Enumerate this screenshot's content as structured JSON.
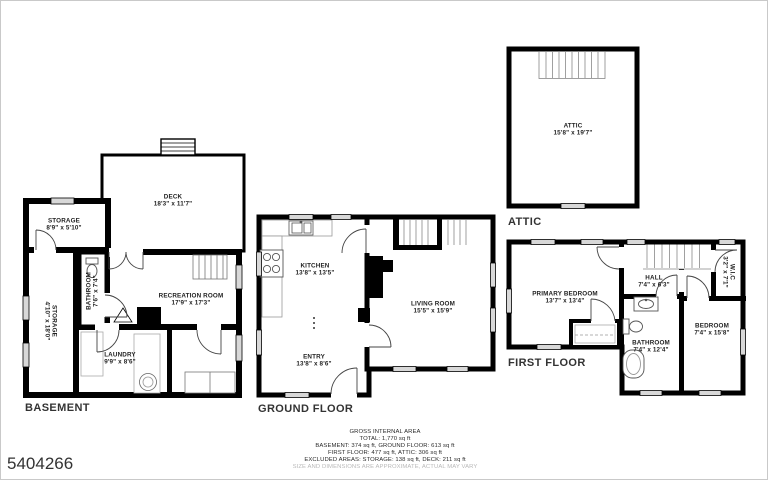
{
  "id_number": "5404266",
  "floors": {
    "basement": {
      "label": "BASEMENT",
      "rooms": {
        "deck": {
          "name": "DECK",
          "dims": "18'3\" x 11'7\""
        },
        "storage_top": {
          "name": "STORAGE",
          "dims": "8'9\" x 5'10\""
        },
        "storage_left": {
          "name": "STORAGE",
          "dims": "4'10\" x 18'0\""
        },
        "bathroom": {
          "name": "BATHROOM",
          "dims": "7'6\" x 7'4\""
        },
        "recreation": {
          "name": "RECREATION ROOM",
          "dims": "17'9\" x 17'3\""
        },
        "laundry": {
          "name": "LAUNDRY",
          "dims": "9'9\" x 8'6\""
        }
      }
    },
    "ground": {
      "label": "GROUND FLOOR",
      "rooms": {
        "kitchen": {
          "name": "KITCHEN",
          "dims": "13'8\" x 13'5\""
        },
        "living": {
          "name": "LIVING ROOM",
          "dims": "15'5\" x 15'9\""
        },
        "entry": {
          "name": "ENTRY",
          "dims": "13'8\" x 8'6\""
        }
      }
    },
    "first": {
      "label": "FIRST FLOOR",
      "rooms": {
        "primary": {
          "name": "PRIMARY BEDROOM",
          "dims": "13'7\" x 13'4\""
        },
        "hall": {
          "name": "HALL",
          "dims": "7'4\" x 6'3\""
        },
        "wic": {
          "name": "W.I.C",
          "dims": "3'2\" x 7'1\""
        },
        "bedroom": {
          "name": "BEDROOM",
          "dims": "7'4\" x 15'8\""
        },
        "bathroom": {
          "name": "BATHROOM",
          "dims": "7'4\" x 12'4\""
        }
      }
    },
    "attic": {
      "label": "ATTIC",
      "rooms": {
        "attic": {
          "name": "ATTIC",
          "dims": "15'8\" x 19'7\""
        }
      }
    }
  },
  "footer": {
    "line1": "GROSS INTERNAL AREA",
    "line2": "TOTAL: 1,770 sq ft",
    "line3": "BASEMENT: 374 sq ft, GROUND FLOOR: 613 sq ft",
    "line4": "FIRST FLOOR: 477 sq ft, ATTIC: 306 sq ft",
    "line5": "EXCLUDED AREAS: STORAGE: 138 sq ft, DECK: 211 sq ft",
    "disclaimer": "SIZE AND DIMENSIONS ARE APPROXIMATE, ACTUAL MAY VARY"
  },
  "colors": {
    "wall": "#000000",
    "window_fill": "#d8d8d8",
    "disclaimer_text": "#b9b9b9"
  }
}
